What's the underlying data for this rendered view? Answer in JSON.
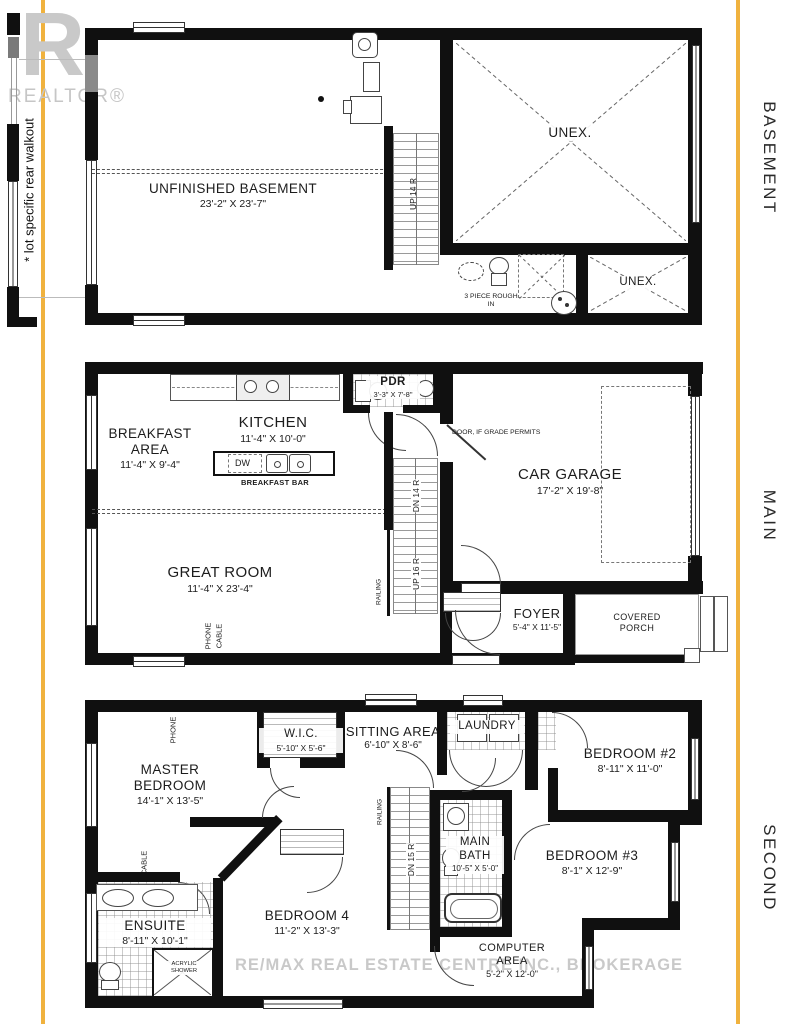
{
  "page": {
    "side_note": "* lot specific rear walkout",
    "floor_labels": {
      "basement": "BASEMENT",
      "main": "MAIN",
      "second": "SECOND"
    },
    "watermark": {
      "logo_r": "R",
      "logo_text": "REALTOR®",
      "brokerage": "RE/MAX REAL ESTATE CENTRE INC., BROKERAGE"
    },
    "accent_color": "#F0B23E"
  },
  "basement": {
    "rooms": {
      "unfinished": {
        "name": "UNFINISHED BASEMENT",
        "dims": "23'-2\" X 23'-7\""
      },
      "unex_large": {
        "name": "UNEX."
      },
      "unex_small": {
        "name": "UNEX."
      },
      "rough_in": {
        "name": "3 PIECE ROUGH IN"
      }
    },
    "stairs": {
      "up": "UP 14 R"
    }
  },
  "main": {
    "rooms": {
      "breakfast": {
        "name": "BREAKFAST AREA",
        "dims": "11'-4\" X 9'-4\""
      },
      "kitchen": {
        "name": "KITCHEN",
        "dims": "11'-4\" X 10'-0\""
      },
      "pdr": {
        "name": "PDR",
        "dims": "3'-3\" X 7'-8\""
      },
      "great_room": {
        "name": "GREAT ROOM",
        "dims": "11'-4\" X 23'-4\""
      },
      "garage": {
        "name": "CAR GARAGE",
        "dims": "17'-2\" X 19'-8\""
      },
      "foyer": {
        "name": "FOYER",
        "dims": "5'-4\" X 11'-5\""
      },
      "porch": {
        "name": "COVERED PORCH"
      }
    },
    "labels": {
      "breakfast_bar": "BREAKFAST BAR",
      "dw": "DW",
      "door_note": "DOOR, IF GRADE PERMITS",
      "railing": "RAILING",
      "phone": "PHONE",
      "cable": "CABLE"
    },
    "stairs": {
      "dn": "DN 14 R",
      "up": "UP 16 R"
    }
  },
  "second": {
    "rooms": {
      "master": {
        "name": "MASTER BEDROOM",
        "dims": "14'-1\" X 13'-5\""
      },
      "wic": {
        "name": "W.I.C.",
        "dims": "5'-10\" X 5'-6\""
      },
      "sitting": {
        "name": "SITTING AREA",
        "dims": "6'-10\" X 8'-6\""
      },
      "laundry": {
        "name": "LAUNDRY"
      },
      "bedroom2": {
        "name": "BEDROOM #2",
        "dims": "8'-11\" X 11'-0\""
      },
      "bedroom3": {
        "name": "BEDROOM #3",
        "dims": "8'-1\" X 12'-9\""
      },
      "bedroom4": {
        "name": "BEDROOM 4",
        "dims": "11'-2\" X 13'-3\""
      },
      "ensuite": {
        "name": "ENSUITE",
        "dims": "8'-11\" X 10'-1\""
      },
      "main_bath": {
        "name": "MAIN BATH",
        "dims": "10'-5\" X 5'-0\""
      },
      "computer": {
        "name": "COMPUTER AREA",
        "dims": "5'-2\" X 12'-0\""
      }
    },
    "labels": {
      "acrylic_shower": "ACRYLIC SHOWER",
      "railing": "RAILING",
      "phone": "PHONE",
      "cable": "CABLE"
    },
    "stairs": {
      "dn": "DN 15 R"
    }
  }
}
